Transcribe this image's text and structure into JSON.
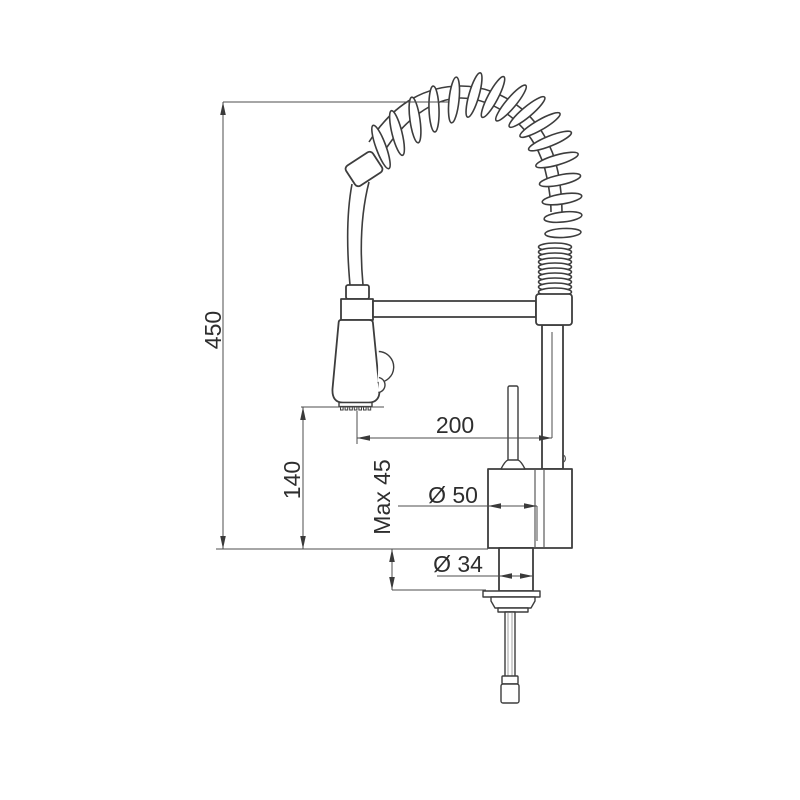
{
  "drawing": {
    "type": "technical dimension drawing",
    "subject": "kitchen mixer tap with pull-down spring spout",
    "colors": {
      "background": "#ffffff",
      "outline": "#3d3d3d",
      "dimension_lines": "#4d4d4d",
      "text": "#2e2e2e"
    },
    "dimensions": {
      "overall_height": "450",
      "spout_clearance_height": "140",
      "spout_reach": "200",
      "max_mounting_thickness": "Max 45",
      "body_diameter": "Ø 50",
      "shank_diameter": "Ø 34"
    }
  }
}
